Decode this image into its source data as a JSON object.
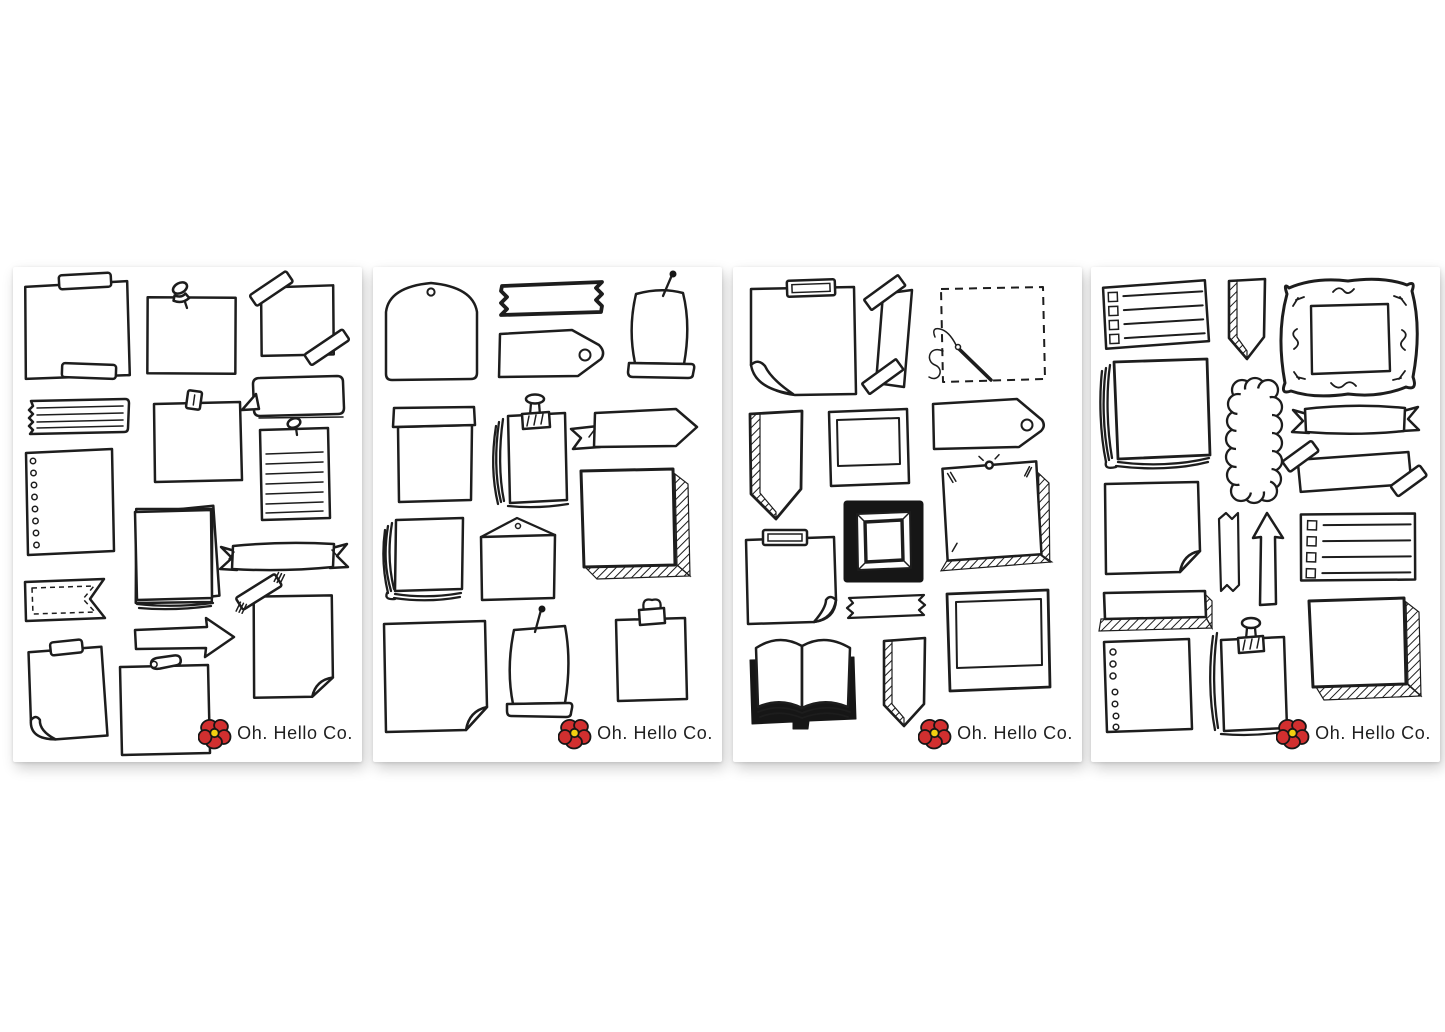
{
  "page": {
    "background_color": "#ffffff",
    "sheet_color": "#ffffff"
  },
  "brand": {
    "logo_text": "Oh. Hello Co.",
    "ink": "#1d1d1d",
    "poppy_red": "#d12f2f",
    "poppy_center_yellow": "#f3d010"
  },
  "sheets": [
    {
      "name": "sheet-1",
      "stickers": [
        "taped-note",
        "pinned-note",
        "corner-taped-note",
        "torn-lined-strip",
        "clipped-note",
        "speech-bubble",
        "hole-punched-paper",
        "pinned-lined-note",
        "paper-stack",
        "ribbon-banner",
        "stitched-flag",
        "arrow-right",
        "taped-curl-paper",
        "taped-sticky-note",
        "safety-pin-note"
      ]
    },
    {
      "name": "sheet-2",
      "stickers": [
        "envelope-hole-flap",
        "bold-washi-tape",
        "gift-tag",
        "pinned-scroll",
        "pocket-pouch",
        "clipped-paper-stack",
        "pennant-ribbon",
        "shadowed-square",
        "layered-napkin",
        "envelope-triangle-flap",
        "folded-corner-square",
        "pinned-scroll-2",
        "binder-clip-note"
      ]
    },
    {
      "name": "sheet-3",
      "stickers": [
        "taped-curl-note",
        "diagonal-washi-strip",
        "stitched-dashed-square",
        "hatched-pennant",
        "polaroid-frame",
        "gift-tag",
        "pinned-shadow-note",
        "bold-picture-frame",
        "taped-curl-note-2",
        "small-washi-tape",
        "open-book",
        "hatched-bookmark",
        "polaroid-frame-large"
      ]
    },
    {
      "name": "sheet-4",
      "stickers": [
        "checklist-note",
        "hatched-bookmark",
        "ornate-frame",
        "paper-stack",
        "scalloped-strip",
        "ribbon-banner",
        "double-taped-note",
        "folded-corner-sticky",
        "vertical-washi-tape",
        "arrow-up",
        "checklist-note-2",
        "shadowed-bar",
        "hole-punched-paper",
        "clipped-paper-stack",
        "shadowed-square"
      ]
    }
  ]
}
